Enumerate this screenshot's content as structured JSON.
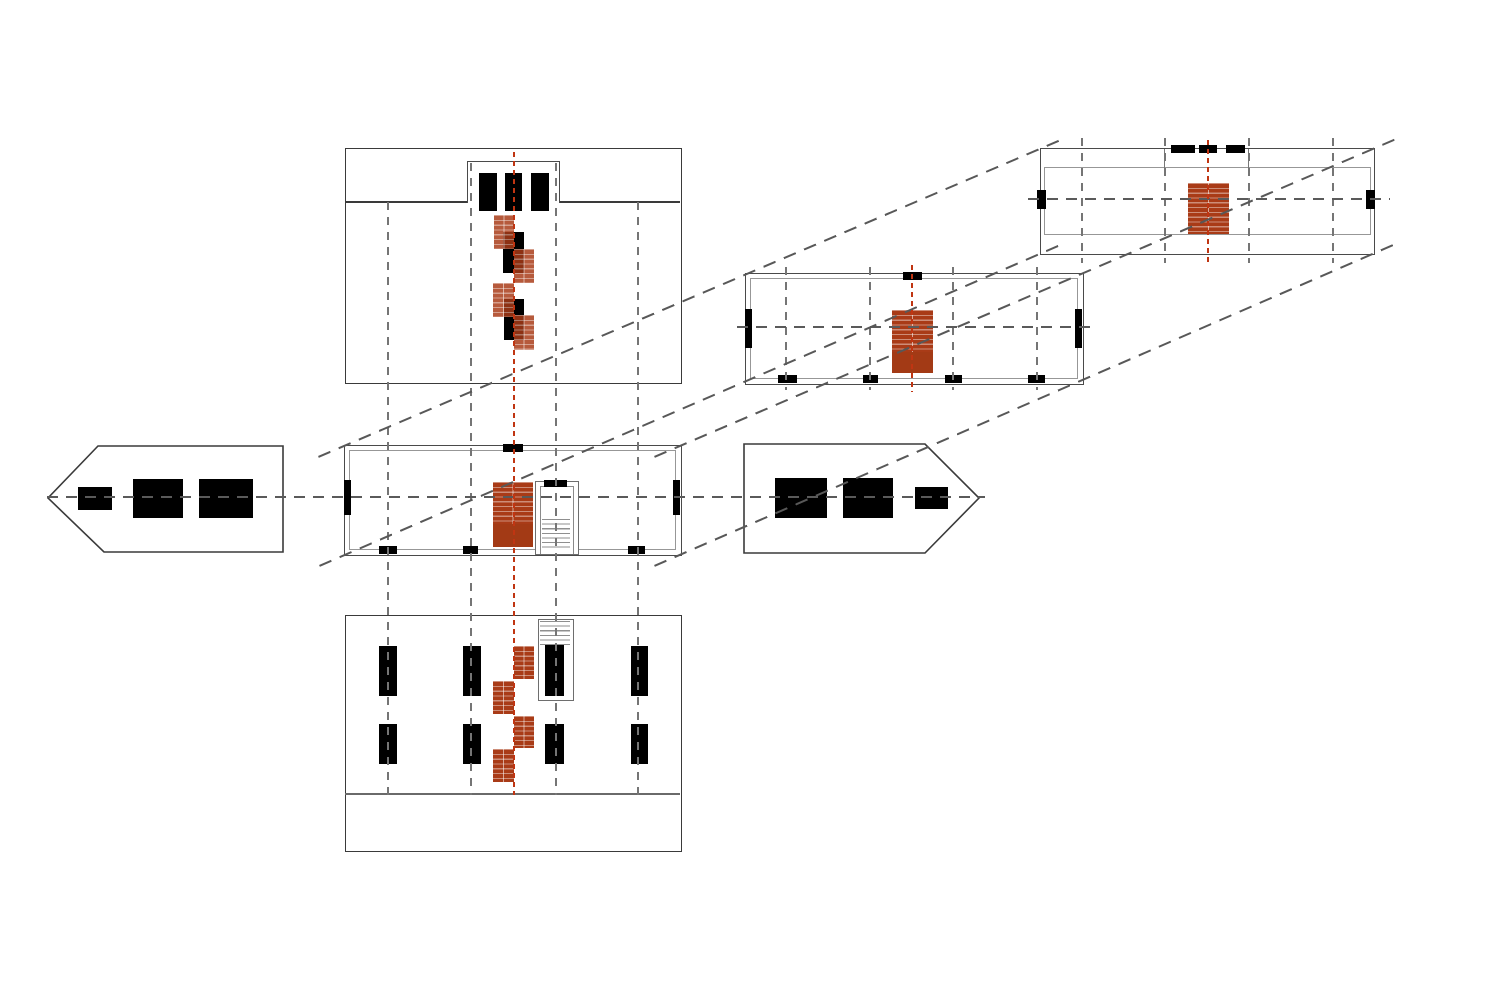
{
  "drawing": {
    "kind": "architectural exploded orthographic projection",
    "description": "Unfolded projection set of a rectangular pavilion: ground-floor plan, upper-floor plan and roof plan linked by dashed projection diagonals, plus front elevation, basement plan and two arrow-shaped side section markers. Stair runs are highlighted in terracotta with red centre axes.",
    "colors": {
      "background": "#FFFFFF",
      "ink": "#3A3A3A",
      "wall_gray": "#4A4A4A",
      "inner_wall_gray": "#979797",
      "grid_dash_gray": "#757575",
      "section_dash_gray": "#5A5A5A",
      "stair_terracotta": "#A93B17",
      "stair_axis_red": "#C03512",
      "opening_black": "#000000"
    },
    "projection": {
      "axis_angle_deg": -23.3,
      "diagonal_count": 4,
      "line_style": "dashed"
    },
    "panels": [
      {
        "id": "front-elevation",
        "label": "Front elevation with roof band, dormer, three window openings and cascading stair flights"
      },
      {
        "id": "ground-floor-plan",
        "label": "Ground-floor plan with terracotta stair run, open stairwell with treads and black wall openings"
      },
      {
        "id": "basement-plan",
        "label": "Basement plan with eight black piers, zig-zag terracotta stair flights and stairwell treads"
      },
      {
        "id": "left-section-marker",
        "label": "Left-pointing section marker with three black openings"
      },
      {
        "id": "right-section-marker",
        "label": "Right-pointing section marker with three black openings"
      },
      {
        "id": "upper-floor-plan",
        "label": "Upper-floor plan with terracotta stair run and black wall openings"
      },
      {
        "id": "roof-plan",
        "label": "Roof plan with dormer notch, dashed ridge openings and terracotta stair run"
      }
    ],
    "stair_runs": {
      "terracotta_count": 10,
      "tread_hatch": "horizontal",
      "axis_lines": 3
    },
    "grid": {
      "elevation_column_axes_x": [
        388,
        471,
        556,
        638
      ],
      "upper_plan_axes_x": [
        786,
        870,
        953,
        1037
      ],
      "roof_plan_axes_x": [
        1082,
        1165,
        1249,
        1333
      ],
      "red_axes_x": [
        514,
        912,
        1208
      ],
      "section_axes_y": [
        497,
        327,
        199
      ]
    },
    "openings": {
      "plan_edge_ticks": 16,
      "basement_piers": 8,
      "elevation_windows": 3,
      "marker_openings": 6
    }
  }
}
